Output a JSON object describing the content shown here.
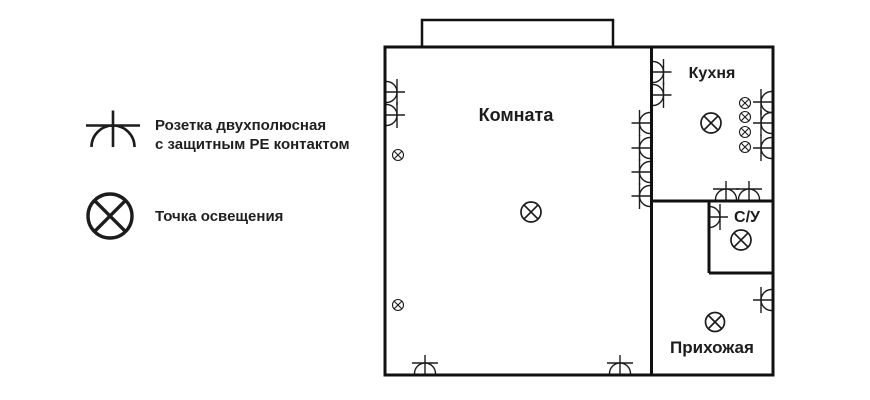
{
  "colors": {
    "ink": "#1c1c1c",
    "wall": "#111111",
    "bg": "#ffffff"
  },
  "legend": {
    "items": [
      {
        "symbol": "socket-pe",
        "label": "Розетка двухполюсная\nс защитным PE контактом"
      },
      {
        "symbol": "light-point",
        "label": "Точка освещения"
      }
    ],
    "socket_icon": {
      "x": 113,
      "y": 147,
      "r": 21.5,
      "ext": 15,
      "cb": 27,
      "sw": 2.6,
      "dir": "up"
    },
    "light_icon": {
      "x": 110,
      "y": 216,
      "r": 22,
      "sw": 3.4
    }
  },
  "plan": {
    "rooms": [
      {
        "id": "komnata",
        "name": "Комната",
        "x": 516,
        "y": 121,
        "size": 18
      },
      {
        "id": "kuhnya",
        "name": "Кухня",
        "x": 712,
        "y": 78,
        "size": 16
      },
      {
        "id": "su",
        "name": "С/У",
        "x": 747,
        "y": 222,
        "size": 16
      },
      {
        "id": "prihozhaya",
        "name": "Прихожая",
        "x": 712,
        "y": 353,
        "size": 17
      }
    ],
    "walls": [
      {
        "type": "rect",
        "name": "outer-wall",
        "x": 385,
        "y": 47,
        "w": 388,
        "h": 328,
        "sw": 3
      },
      {
        "type": "rect",
        "name": "balcony-outline",
        "x": 422,
        "y": 20,
        "w": 191,
        "h": 27,
        "sw": 2.5
      },
      {
        "type": "line",
        "name": "divider-wall",
        "x1": 651.5,
        "y1": 47,
        "x2": 651.5,
        "y2": 375,
        "sw": 3
      },
      {
        "type": "line",
        "name": "kitchen-south-wall",
        "x1": 651.5,
        "y1": 201,
        "x2": 773,
        "y2": 201,
        "sw": 3
      },
      {
        "type": "line",
        "name": "bathroom-west-wall",
        "x1": 709,
        "y1": 201,
        "x2": 709,
        "y2": 273,
        "sw": 3
      },
      {
        "type": "line",
        "name": "bathroom-south-wall",
        "x1": 709,
        "y1": 273,
        "x2": 773,
        "y2": 273,
        "sw": 3
      }
    ],
    "socket_style": {
      "r": 10.5,
      "ext": 8,
      "cb": 13,
      "sw": 1.4
    },
    "sockets": [
      {
        "x": 386.5,
        "y": 92,
        "dir": "right"
      },
      {
        "x": 386.5,
        "y": 115,
        "dir": "right"
      },
      {
        "x": 650,
        "y": 123,
        "dir": "left"
      },
      {
        "x": 650,
        "y": 148,
        "dir": "left"
      },
      {
        "x": 650,
        "y": 172,
        "dir": "left"
      },
      {
        "x": 650,
        "y": 196,
        "dir": "left"
      },
      {
        "x": 653,
        "y": 72,
        "dir": "right"
      },
      {
        "x": 653,
        "y": 95,
        "dir": "right"
      },
      {
        "x": 771.5,
        "y": 102,
        "dir": "left"
      },
      {
        "x": 771.5,
        "y": 123,
        "dir": "left"
      },
      {
        "x": 771.5,
        "y": 148,
        "dir": "left"
      },
      {
        "x": 726,
        "y": 199.5,
        "dir": "up"
      },
      {
        "x": 749,
        "y": 199.5,
        "dir": "up"
      },
      {
        "x": 709.5,
        "y": 217,
        "dir": "right"
      },
      {
        "x": 771.5,
        "y": 300,
        "dir": "left"
      },
      {
        "x": 425,
        "y": 373.5,
        "dir": "up"
      },
      {
        "x": 620,
        "y": 373.5,
        "dir": "up"
      }
    ],
    "light_style": {
      "sw": 1.7
    },
    "lights": [
      {
        "x": 531,
        "y": 212,
        "r": 10
      },
      {
        "x": 711,
        "y": 123,
        "r": 10
      },
      {
        "x": 741,
        "y": 240,
        "r": 10
      },
      {
        "x": 715,
        "y": 322,
        "r": 9.5
      }
    ],
    "wall_light_style": {
      "r": 5.5,
      "sw": 1.1
    },
    "wall_lights": [
      {
        "x": 398,
        "y": 155
      },
      {
        "x": 398,
        "y": 305
      },
      {
        "x": 745,
        "y": 103
      },
      {
        "x": 745,
        "y": 117
      },
      {
        "x": 745,
        "y": 132
      },
      {
        "x": 745,
        "y": 147
      }
    ]
  }
}
